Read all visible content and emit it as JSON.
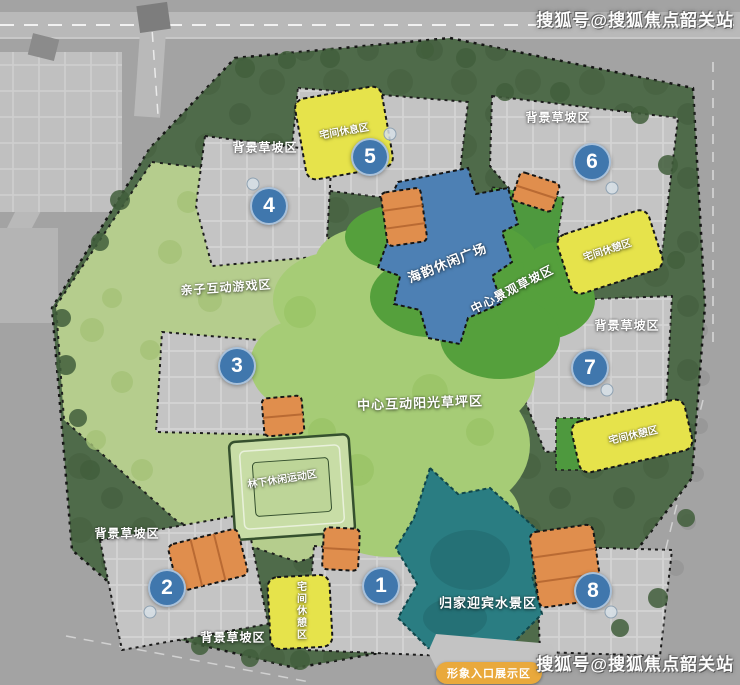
{
  "watermarks": {
    "top_right": "搜狐号@搜狐焦点韶关站",
    "bottom_right": "搜狐号@搜狐焦点韶关站"
  },
  "labels": {
    "bg_slope": "背景草坡区",
    "parent_child_play": "亲子互动游戏区",
    "haiyun_plaza": "海韵休闲广场",
    "central_view_slope": "中心景观草坡区",
    "central_sun_lawn": "中心互动阳光草坪区",
    "forest_leisure_sport": "林下休闲运动区",
    "welcome_water": "归家迎宾水景区",
    "entrance_display": "形象入口展示区",
    "rest_area_top": "宅间休息区",
    "rest_area_right_upper": "宅间休憩区",
    "rest_area_right_lower": "宅间休憩区",
    "rest_area_bottom": "宅间休憩区"
  },
  "buildings": [
    "1",
    "2",
    "3",
    "4",
    "5",
    "6",
    "7",
    "8"
  ],
  "colors": {
    "background_slope_green": "#4f6b4a",
    "light_play_green": "#b9d190",
    "lawn_green": "#a6cc76",
    "view_slope_green": "#55a03c",
    "plaza_blue": "#4d80b4",
    "water_teal": "#2a7d82",
    "facility_orange": "#e08e4d",
    "rest_yellow": "#e6e34b",
    "plot_gray": "#c4c4c4",
    "number_circle_blue": "#4077ad"
  }
}
